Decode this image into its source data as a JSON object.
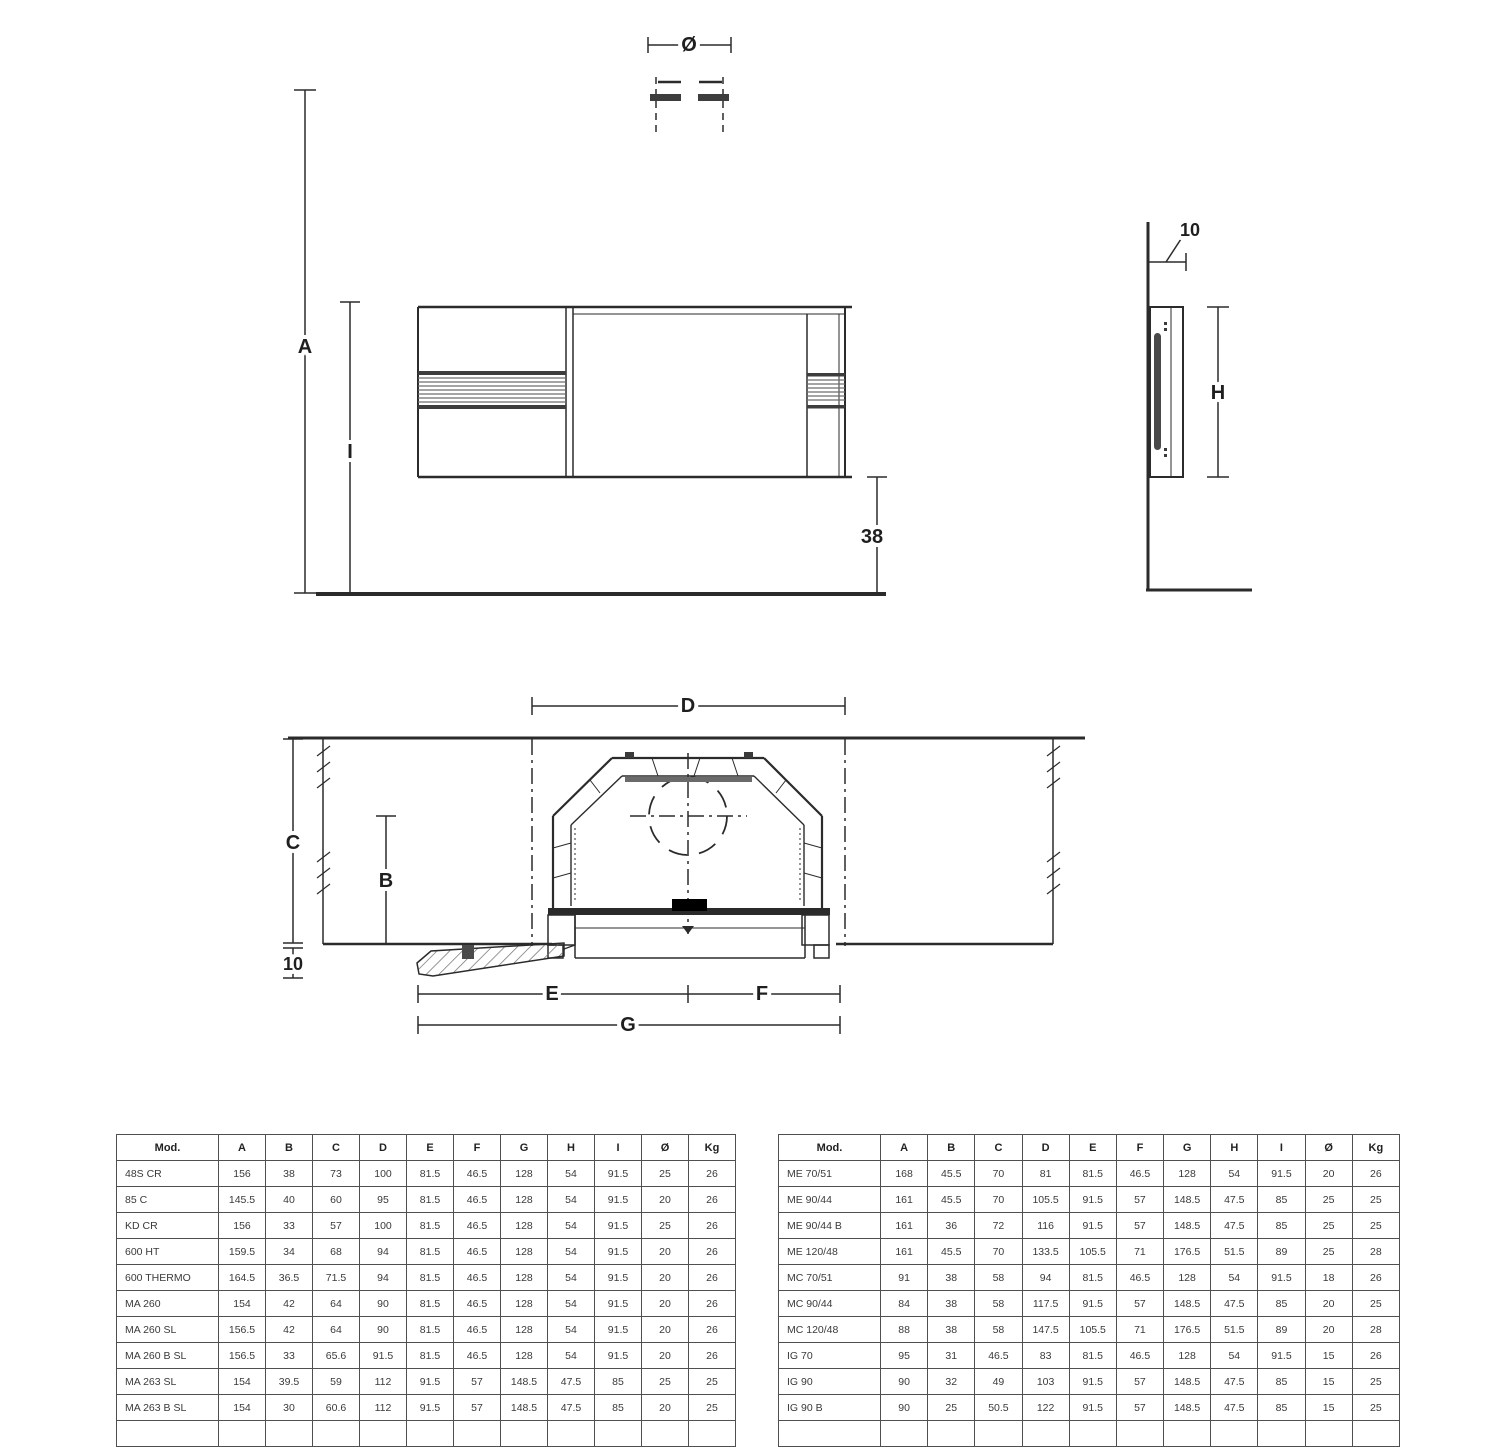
{
  "drawing": {
    "front_view": {
      "labels": {
        "a": "A",
        "i": "I",
        "offset": "38",
        "diameter": "Ø"
      }
    },
    "side_view": {
      "labels": {
        "wall_gap": "10",
        "h": "H"
      }
    },
    "plan_view": {
      "labels": {
        "d": "D",
        "c": "C",
        "b": "B",
        "depth": "10",
        "e": "E",
        "f": "F",
        "g": "G"
      }
    }
  },
  "tables": {
    "left": {
      "headers": [
        "Mod.",
        "A",
        "B",
        "C",
        "D",
        "E",
        "F",
        "G",
        "H",
        "I",
        "Ø",
        "Kg"
      ],
      "rows": [
        [
          "48S CR",
          "156",
          "38",
          "73",
          "100",
          "81.5",
          "46.5",
          "128",
          "54",
          "91.5",
          "25",
          "26"
        ],
        [
          "85 C",
          "145.5",
          "40",
          "60",
          "95",
          "81.5",
          "46.5",
          "128",
          "54",
          "91.5",
          "20",
          "26"
        ],
        [
          "KD CR",
          "156",
          "33",
          "57",
          "100",
          "81.5",
          "46.5",
          "128",
          "54",
          "91.5",
          "25",
          "26"
        ],
        [
          "600 HT",
          "159.5",
          "34",
          "68",
          "94",
          "81.5",
          "46.5",
          "128",
          "54",
          "91.5",
          "20",
          "26"
        ],
        [
          "600 THERMO",
          "164.5",
          "36.5",
          "71.5",
          "94",
          "81.5",
          "46.5",
          "128",
          "54",
          "91.5",
          "20",
          "26"
        ],
        [
          "MA 260",
          "154",
          "42",
          "64",
          "90",
          "81.5",
          "46.5",
          "128",
          "54",
          "91.5",
          "20",
          "26"
        ],
        [
          "MA 260 SL",
          "156.5",
          "42",
          "64",
          "90",
          "81.5",
          "46.5",
          "128",
          "54",
          "91.5",
          "20",
          "26"
        ],
        [
          "MA 260 B SL",
          "156.5",
          "33",
          "65.6",
          "91.5",
          "81.5",
          "46.5",
          "128",
          "54",
          "91.5",
          "20",
          "26"
        ],
        [
          "MA 263 SL",
          "154",
          "39.5",
          "59",
          "112",
          "91.5",
          "57",
          "148.5",
          "47.5",
          "85",
          "25",
          "25"
        ],
        [
          "MA 263 B SL",
          "154",
          "30",
          "60.6",
          "112",
          "91.5",
          "57",
          "148.5",
          "47.5",
          "85",
          "20",
          "25"
        ]
      ]
    },
    "right": {
      "headers": [
        "Mod.",
        "A",
        "B",
        "C",
        "D",
        "E",
        "F",
        "G",
        "H",
        "I",
        "Ø",
        "Kg"
      ],
      "rows": [
        [
          "ME 70/51",
          "168",
          "45.5",
          "70",
          "81",
          "81.5",
          "46.5",
          "128",
          "54",
          "91.5",
          "20",
          "26"
        ],
        [
          "ME 90/44",
          "161",
          "45.5",
          "70",
          "105.5",
          "91.5",
          "57",
          "148.5",
          "47.5",
          "85",
          "25",
          "25"
        ],
        [
          "ME 90/44 B",
          "161",
          "36",
          "72",
          "116",
          "91.5",
          "57",
          "148.5",
          "47.5",
          "85",
          "25",
          "25"
        ],
        [
          "ME 120/48",
          "161",
          "45.5",
          "70",
          "133.5",
          "105.5",
          "71",
          "176.5",
          "51.5",
          "89",
          "25",
          "28"
        ],
        [
          "MC 70/51",
          "91",
          "38",
          "58",
          "94",
          "81.5",
          "46.5",
          "128",
          "54",
          "91.5",
          "18",
          "26"
        ],
        [
          "MC 90/44",
          "84",
          "38",
          "58",
          "117.5",
          "91.5",
          "57",
          "148.5",
          "47.5",
          "85",
          "20",
          "25"
        ],
        [
          "MC 120/48",
          "88",
          "38",
          "58",
          "147.5",
          "105.5",
          "71",
          "176.5",
          "51.5",
          "89",
          "20",
          "28"
        ],
        [
          "IG 70",
          "95",
          "31",
          "46.5",
          "83",
          "81.5",
          "46.5",
          "128",
          "54",
          "91.5",
          "15",
          "26"
        ],
        [
          "IG 90",
          "90",
          "32",
          "49",
          "103",
          "91.5",
          "57",
          "148.5",
          "47.5",
          "85",
          "15",
          "25"
        ],
        [
          "IG 90 B",
          "90",
          "25",
          "50.5",
          "122",
          "91.5",
          "57",
          "148.5",
          "47.5",
          "85",
          "15",
          "25"
        ]
      ]
    }
  }
}
